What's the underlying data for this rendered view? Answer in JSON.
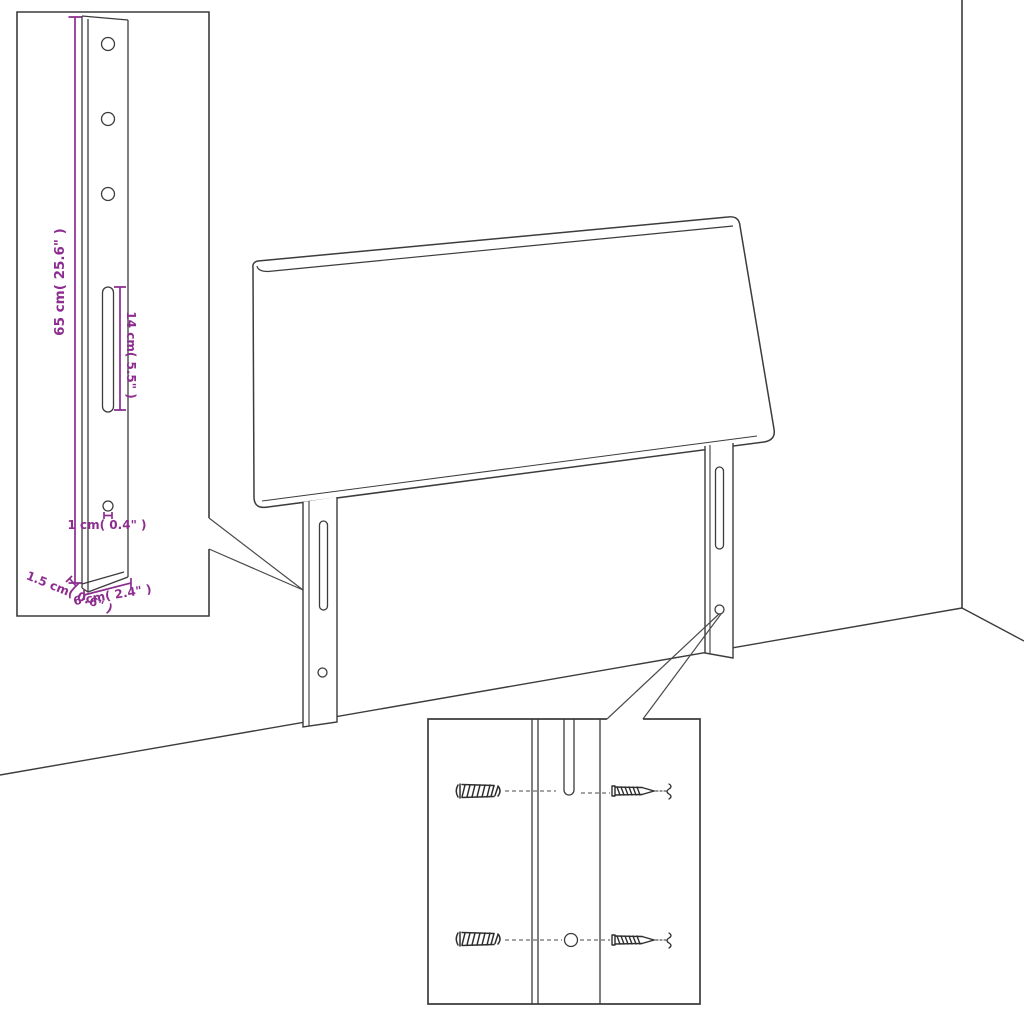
{
  "diagram": {
    "kind": "furniture-assembly-dimension-diagram",
    "subject": "headboard with two slotted mounting legs shown against a room corner",
    "background": "#ffffff"
  },
  "colors": {
    "outline": "#3c3c3c",
    "dimension": "#8c2d8f"
  },
  "bracket_detail_inset": {
    "height_label": "65 cm( 25.6\" )",
    "slot_label": "14 cm( 5.5\" )",
    "hole_label": "1 cm( 0.4\" )",
    "thickness_label": "1.5 cm( 0.6\" )",
    "width_label": "6 cm( 2.4\" )",
    "hole_count": 3
  },
  "hardware_detail_inset": {
    "wall_plug_icon": "ribbed-wall-plug",
    "screw_icon": "pointed-wood-screw",
    "rows": 2
  }
}
